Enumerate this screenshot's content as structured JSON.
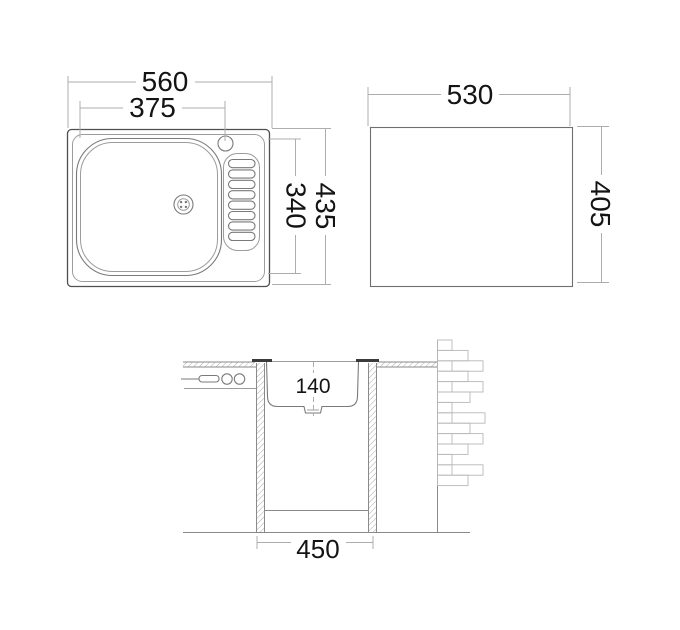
{
  "colors": {
    "background": "#ffffff",
    "drawing_line": "#7a7a7a",
    "dimension_line": "#adadad",
    "label_text": "#141414"
  },
  "top_view": {
    "overall_width": "560",
    "bowl_width": "375",
    "overall_depth": "435",
    "bowl_depth": "340"
  },
  "cutout_view": {
    "width": "530",
    "height": "405"
  },
  "section_view": {
    "bowl_depth": "140",
    "base_width": "450"
  }
}
